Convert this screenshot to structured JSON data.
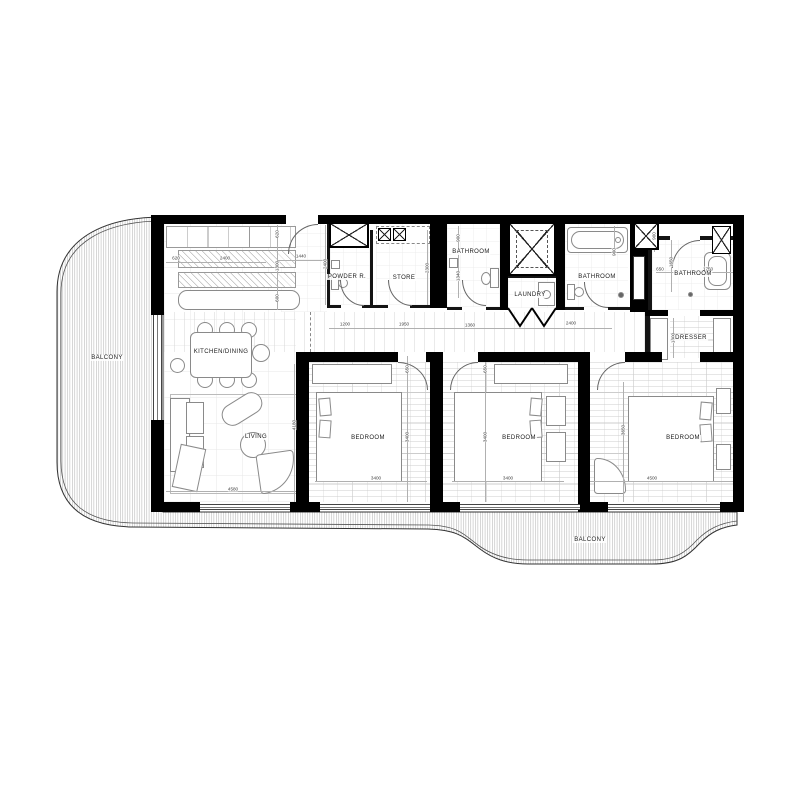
{
  "palette": {
    "wall": "#000000",
    "hatch_line": "#b5b5b5",
    "furniture_line": "#8a8a8a",
    "dim_text": "#444444",
    "label_text": "#1a1a1a"
  },
  "labels": [
    {
      "id": "balcony-left",
      "text": "BALCONY",
      "x": 107,
      "y": 358
    },
    {
      "id": "kitchen-dining",
      "text": "KITCHEN/DINING",
      "x": 221,
      "y": 352
    },
    {
      "id": "living",
      "text": "LIVING",
      "x": 256,
      "y": 437
    },
    {
      "id": "powder-room",
      "text": "POWDER R.",
      "x": 347,
      "y": 277
    },
    {
      "id": "store",
      "text": "STORE",
      "x": 404,
      "y": 278
    },
    {
      "id": "bathroom-1",
      "text": "BATHROOM",
      "x": 471,
      "y": 252
    },
    {
      "id": "laundry",
      "text": "LAUNDRY",
      "x": 530,
      "y": 295
    },
    {
      "id": "bathroom-2",
      "text": "BATHROOM",
      "x": 597,
      "y": 277
    },
    {
      "id": "bathroom-3",
      "text": "BATHROOM",
      "x": 693,
      "y": 274
    },
    {
      "id": "dresser",
      "text": "DRESSER",
      "x": 691,
      "y": 338
    },
    {
      "id": "bedroom-1",
      "text": "BEDROOM",
      "x": 368,
      "y": 438
    },
    {
      "id": "bedroom-2",
      "text": "BEDROOM",
      "x": 519,
      "y": 438
    },
    {
      "id": "bedroom-3",
      "text": "BEDROOM",
      "x": 683,
      "y": 438
    },
    {
      "id": "balcony-bottom",
      "text": "BALCONY",
      "x": 590,
      "y": 540
    }
  ],
  "dimensions": [
    {
      "text": "620",
      "x": 176,
      "y": 258,
      "rot": 0
    },
    {
      "text": "2400",
      "x": 225,
      "y": 258,
      "rot": 0
    },
    {
      "text": "1440",
      "x": 301,
      "y": 256,
      "rot": 0
    },
    {
      "text": "620",
      "x": 277,
      "y": 234,
      "rot": 90
    },
    {
      "text": "1300",
      "x": 277,
      "y": 266,
      "rot": 90
    },
    {
      "text": "600",
      "x": 277,
      "y": 298,
      "rot": 90
    },
    {
      "text": "2400",
      "x": 325,
      "y": 264,
      "rot": 90
    },
    {
      "text": "2300",
      "x": 427,
      "y": 268,
      "rot": 90
    },
    {
      "text": "900",
      "x": 458,
      "y": 238,
      "rot": 90
    },
    {
      "text": "1340",
      "x": 458,
      "y": 276,
      "rot": 90
    },
    {
      "text": "900",
      "x": 614,
      "y": 252,
      "rot": 90
    },
    {
      "text": "900",
      "x": 654,
      "y": 236,
      "rot": 90
    },
    {
      "text": "1650",
      "x": 671,
      "y": 262,
      "rot": 90
    },
    {
      "text": "650",
      "x": 660,
      "y": 269,
      "rot": 0
    },
    {
      "text": "1750",
      "x": 708,
      "y": 269,
      "rot": 0
    },
    {
      "text": "1200",
      "x": 345,
      "y": 324,
      "rot": 0
    },
    {
      "text": "1950",
      "x": 404,
      "y": 324,
      "rot": 0
    },
    {
      "text": "1360",
      "x": 470,
      "y": 325,
      "rot": 0
    },
    {
      "text": "2400",
      "x": 571,
      "y": 323,
      "rot": 0
    },
    {
      "text": "650",
      "x": 407,
      "y": 369,
      "rot": 90
    },
    {
      "text": "3400",
      "x": 407,
      "y": 437,
      "rot": 90
    },
    {
      "text": "650",
      "x": 485,
      "y": 369,
      "rot": 90
    },
    {
      "text": "3400",
      "x": 485,
      "y": 437,
      "rot": 90
    },
    {
      "text": "3650",
      "x": 623,
      "y": 430,
      "rot": 90
    },
    {
      "text": "4180",
      "x": 294,
      "y": 425,
      "rot": 90
    },
    {
      "text": "1300",
      "x": 673,
      "y": 338,
      "rot": 90
    },
    {
      "text": "3400",
      "x": 376,
      "y": 478,
      "rot": 0
    },
    {
      "text": "3400",
      "x": 508,
      "y": 478,
      "rot": 0
    },
    {
      "text": "4500",
      "x": 652,
      "y": 478,
      "rot": 0
    },
    {
      "text": "4580",
      "x": 233,
      "y": 489,
      "rot": 0
    }
  ]
}
